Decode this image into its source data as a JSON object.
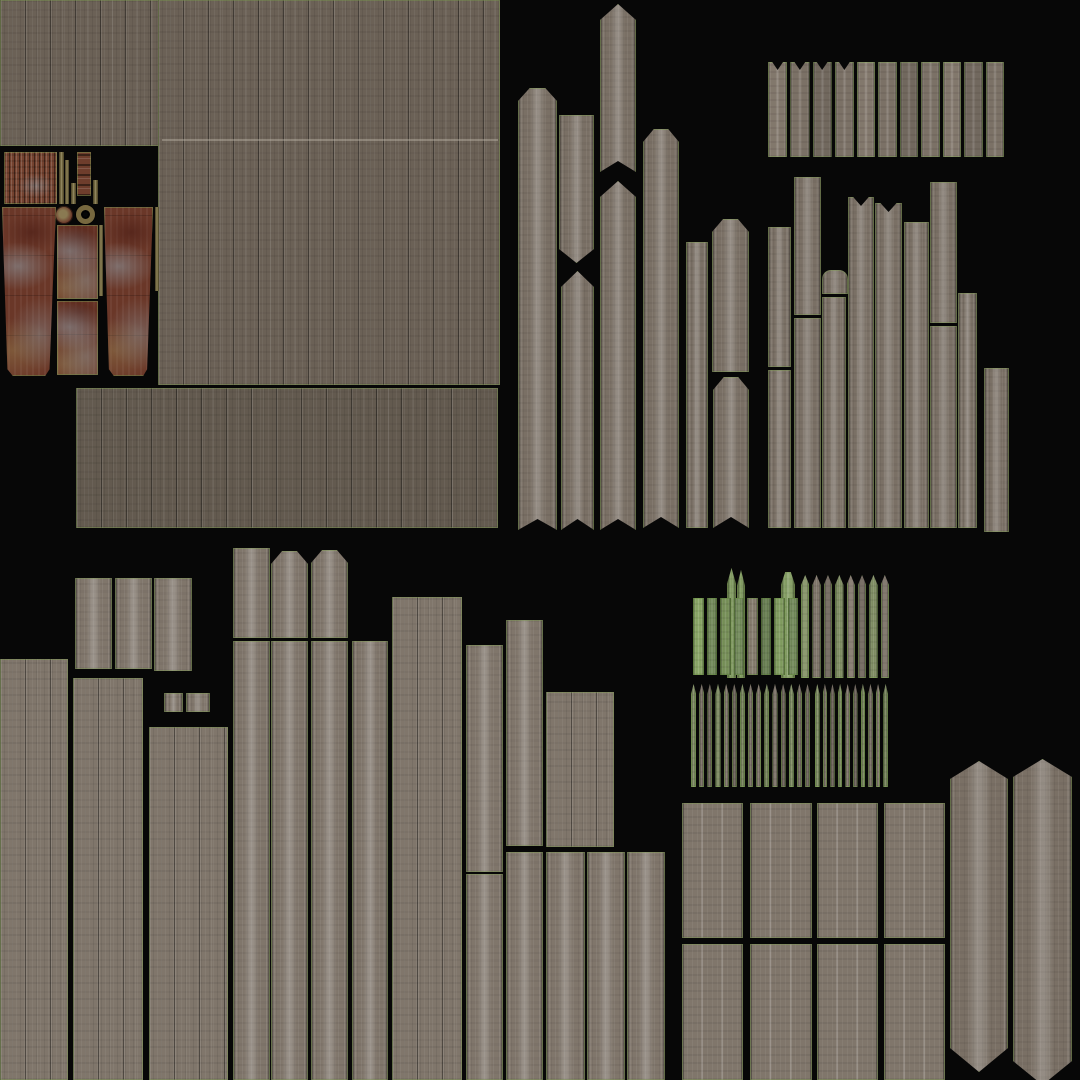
{
  "canvas": {
    "width": 1080,
    "height": 1080,
    "background": "#070707"
  },
  "palette": {
    "wood_brown": "#6b6156",
    "wood_brown_dark": "#635a4f",
    "wood_gray": "#7a7065",
    "wood_light": "#80766b",
    "moss_green": "#7f9a5e",
    "island_border_green": "#7f9b52",
    "rust": "#6a3728",
    "rust_dark": "#54241a",
    "rust_patch_blue": "#8d99a1",
    "rust_khaki": "#7e7347",
    "background_black": "#070707",
    "seam_light": "#c7c0b4"
  },
  "islands": [
    {
      "id": "top-left-strip",
      "material": "wood-boards-brown",
      "shape": "rect",
      "x": 0,
      "y": 0,
      "w": 500,
      "h": 146
    },
    {
      "id": "top-big-block",
      "material": "wood-boards-brown",
      "shape": "rect",
      "x": 158,
      "y": 0,
      "w": 342,
      "h": 385
    },
    {
      "id": "top-big-block-seam",
      "material": "seam-line",
      "shape": "rect",
      "x": 162,
      "y": 139,
      "w": 336,
      "h": 2
    },
    {
      "id": "mid-wide-block",
      "material": "wood-boards-brown-dark",
      "shape": "rect",
      "x": 76,
      "y": 388,
      "w": 422,
      "h": 140
    },
    {
      "id": "rust-corrugated-sheet",
      "material": "rust-corrugated",
      "shape": "rect",
      "x": 4,
      "y": 152,
      "w": 53,
      "h": 52
    },
    {
      "id": "khaki-strip-1",
      "material": "khaki-strip",
      "shape": "rect",
      "x": 59,
      "y": 152,
      "w": 5,
      "h": 52
    },
    {
      "id": "khaki-strip-2",
      "material": "khaki-strip",
      "shape": "rect",
      "x": 65,
      "y": 160,
      "w": 4,
      "h": 44
    },
    {
      "id": "khaki-strip-3",
      "material": "khaki-strip",
      "shape": "rect",
      "x": 71,
      "y": 183,
      "w": 5,
      "h": 21
    },
    {
      "id": "rust-ladder-strip",
      "material": "rust-ladder",
      "shape": "rect",
      "x": 77,
      "y": 152,
      "w": 14,
      "h": 44
    },
    {
      "id": "khaki-strip-4",
      "material": "khaki-strip",
      "shape": "rect",
      "x": 93,
      "y": 180,
      "w": 5,
      "h": 24
    },
    {
      "id": "metal-disc",
      "material": "metal-disc",
      "shape": "rect",
      "x": 55,
      "y": 206,
      "w": 18,
      "h": 18
    },
    {
      "id": "metal-ring",
      "material": "metal-ring",
      "shape": "rect",
      "x": 76,
      "y": 205,
      "w": 19,
      "h": 19
    },
    {
      "id": "rust-panel-left",
      "material": "rust-panel",
      "shape": "taper-bottom",
      "x": 2,
      "y": 207,
      "w": 54,
      "h": 169
    },
    {
      "id": "rust-panel-mid-upper",
      "material": "rust-panel",
      "shape": "rect",
      "x": 57,
      "y": 225,
      "w": 41,
      "h": 74
    },
    {
      "id": "rust-panel-mid-lower",
      "material": "rust-panel",
      "shape": "rect",
      "x": 57,
      "y": 301,
      "w": 41,
      "h": 74
    },
    {
      "id": "khaki-strip-mid",
      "material": "khaki-strip",
      "shape": "rect",
      "x": 99,
      "y": 225,
      "w": 4,
      "h": 71
    },
    {
      "id": "rust-panel-right",
      "material": "rust-panel",
      "shape": "taper-bottom",
      "x": 104,
      "y": 207,
      "w": 49,
      "h": 169
    },
    {
      "id": "khaki-strip-right",
      "material": "khaki-strip",
      "shape": "rect",
      "x": 155,
      "y": 207,
      "w": 4,
      "h": 84
    },
    {
      "id": "mid-plank-a",
      "material": "wood-plank-gray",
      "shape": "chamfer-top-notch-bottom",
      "x": 518,
      "y": 88,
      "w": 39,
      "h": 442
    },
    {
      "id": "mid-plank-b-upper",
      "material": "wood-plank-gray",
      "shape": "point-bottom",
      "x": 559,
      "y": 115,
      "w": 35,
      "h": 148
    },
    {
      "id": "mid-plank-b-lower",
      "material": "wood-plank-gray",
      "shape": "point-top-notch-bottom",
      "x": 561,
      "y": 271,
      "w": 33,
      "h": 259
    },
    {
      "id": "mid-plank-c-upper",
      "material": "wood-plank-gray",
      "shape": "point-top-notch-bottom",
      "x": 600,
      "y": 4,
      "w": 36,
      "h": 168
    },
    {
      "id": "mid-plank-c-lower",
      "material": "wood-plank-gray",
      "shape": "point-top-notch-bottom",
      "x": 600,
      "y": 181,
      "w": 36,
      "h": 349
    },
    {
      "id": "mid-plank-d",
      "material": "wood-plank-gray",
      "shape": "chamfer-top-notch-bottom",
      "x": 643,
      "y": 129,
      "w": 36,
      "h": 399
    },
    {
      "id": "mid-plank-e",
      "material": "wood-plank-gray",
      "shape": "rect",
      "x": 686,
      "y": 242,
      "w": 22,
      "h": 286
    },
    {
      "id": "mid-plank-f",
      "material": "wood-plank-gray",
      "shape": "chamfer-top",
      "x": 712,
      "y": 219,
      "w": 37,
      "h": 153
    },
    {
      "id": "mid-plank-g",
      "material": "wood-plank-gray",
      "shape": "chamfer-top-notch-bottom",
      "x": 713,
      "y": 377,
      "w": 36,
      "h": 151
    },
    {
      "id": "right-plank-1-upper",
      "material": "wood-plank-gray",
      "shape": "rect",
      "x": 768,
      "y": 227,
      "w": 23,
      "h": 140
    },
    {
      "id": "right-plank-1-lower",
      "material": "wood-plank-gray",
      "shape": "rect",
      "x": 768,
      "y": 370,
      "w": 23,
      "h": 158
    },
    {
      "id": "right-plank-2-upper",
      "material": "wood-plank-gray",
      "shape": "rect",
      "x": 794,
      "y": 177,
      "w": 27,
      "h": 138
    },
    {
      "id": "right-plank-2-lower",
      "material": "wood-plank-gray",
      "shape": "rect",
      "x": 794,
      "y": 318,
      "w": 27,
      "h": 210
    },
    {
      "id": "right-knob-piece",
      "material": "wood-plank-gray",
      "shape": "round-top",
      "x": 822,
      "y": 270,
      "w": 26,
      "h": 24
    },
    {
      "id": "right-plank-3",
      "material": "wood-plank-gray",
      "shape": "rect",
      "x": 822,
      "y": 297,
      "w": 24,
      "h": 231
    },
    {
      "id": "right-plank-4",
      "material": "wood-plank-gray",
      "shape": "notch-ears-top",
      "x": 848,
      "y": 197,
      "w": 26,
      "h": 331
    },
    {
      "id": "right-plank-5",
      "material": "wood-plank-gray",
      "shape": "notch-ears-top",
      "x": 875,
      "y": 203,
      "w": 27,
      "h": 325
    },
    {
      "id": "right-plank-6",
      "material": "wood-plank-gray",
      "shape": "rect",
      "x": 904,
      "y": 222,
      "w": 25,
      "h": 306
    },
    {
      "id": "right-plank-7-upper",
      "material": "wood-plank-gray",
      "shape": "rect",
      "x": 930,
      "y": 182,
      "w": 27,
      "h": 141
    },
    {
      "id": "right-plank-7-lower",
      "material": "wood-plank-gray",
      "shape": "rect",
      "x": 930,
      "y": 326,
      "w": 27,
      "h": 202
    },
    {
      "id": "right-plank-8",
      "material": "wood-plank-gray",
      "shape": "rect",
      "x": 958,
      "y": 293,
      "w": 19,
      "h": 235
    },
    {
      "id": "right-plank-9",
      "material": "wood-plank-gray",
      "shape": "rect",
      "x": 984,
      "y": 368,
      "w": 25,
      "h": 164
    },
    {
      "id": "bottom-plank-1",
      "material": "wood-plank-light",
      "shape": "rect",
      "x": 75,
      "y": 578,
      "w": 37,
      "h": 91
    },
    {
      "id": "bottom-plank-2",
      "material": "wood-plank-light",
      "shape": "rect",
      "x": 115,
      "y": 578,
      "w": 37,
      "h": 91
    },
    {
      "id": "bottom-plank-3",
      "material": "wood-plank-light",
      "shape": "rect",
      "x": 154,
      "y": 578,
      "w": 38,
      "h": 93
    },
    {
      "id": "bottom-board-left-edge",
      "material": "wood-boards-light",
      "shape": "rect",
      "x": 0,
      "y": 659,
      "w": 68,
      "h": 421
    },
    {
      "id": "bottom-board-2",
      "material": "wood-boards-light",
      "shape": "rect",
      "x": 73,
      "y": 678,
      "w": 70,
      "h": 402
    },
    {
      "id": "small-square-1",
      "material": "wood-plank-light",
      "shape": "rect",
      "x": 164,
      "y": 693,
      "w": 19,
      "h": 19
    },
    {
      "id": "small-square-2",
      "material": "wood-plank-light",
      "shape": "rect",
      "x": 186,
      "y": 693,
      "w": 24,
      "h": 19
    },
    {
      "id": "bottom-board-3",
      "material": "wood-boards-light",
      "shape": "rect",
      "x": 149,
      "y": 727,
      "w": 79,
      "h": 353
    },
    {
      "id": "bottom-plank-4-upper",
      "material": "wood-plank-light",
      "shape": "rect",
      "x": 233,
      "y": 548,
      "w": 37,
      "h": 90
    },
    {
      "id": "bottom-plank-4-lower",
      "material": "wood-plank-light",
      "shape": "rect",
      "x": 233,
      "y": 641,
      "w": 37,
      "h": 439
    },
    {
      "id": "bottom-plank-5-upper",
      "material": "wood-plank-light",
      "shape": "chamfer-top",
      "x": 271,
      "y": 551,
      "w": 37,
      "h": 87
    },
    {
      "id": "bottom-plank-5-lower",
      "material": "wood-plank-light",
      "shape": "rect",
      "x": 271,
      "y": 641,
      "w": 37,
      "h": 439
    },
    {
      "id": "bottom-plank-6-upper",
      "material": "wood-plank-light",
      "shape": "chamfer-top",
      "x": 311,
      "y": 550,
      "w": 37,
      "h": 88
    },
    {
      "id": "bottom-plank-6-lower",
      "material": "wood-plank-light",
      "shape": "rect",
      "x": 311,
      "y": 641,
      "w": 37,
      "h": 439
    },
    {
      "id": "bottom-plank-7",
      "material": "wood-plank-light",
      "shape": "rect",
      "x": 352,
      "y": 641,
      "w": 36,
      "h": 439
    },
    {
      "id": "bottom-board-wide",
      "material": "wood-boards-light",
      "shape": "rect",
      "x": 392,
      "y": 597,
      "w": 70,
      "h": 483
    },
    {
      "id": "bottom-plank-8-upper",
      "material": "wood-plank-light",
      "shape": "rect",
      "x": 466,
      "y": 645,
      "w": 37,
      "h": 227
    },
    {
      "id": "bottom-plank-8-lower",
      "material": "wood-plank-light",
      "shape": "rect",
      "x": 466,
      "y": 874,
      "w": 37,
      "h": 206
    },
    {
      "id": "bottom-plank-9-upper",
      "material": "wood-plank-light",
      "shape": "rect",
      "x": 506,
      "y": 620,
      "w": 37,
      "h": 226
    },
    {
      "id": "bottom-plank-9-lower",
      "material": "wood-plank-light",
      "shape": "rect",
      "x": 506,
      "y": 852,
      "w": 37,
      "h": 228
    },
    {
      "id": "bottom-board-mid",
      "material": "wood-boards-light",
      "shape": "rect",
      "x": 546,
      "y": 692,
      "w": 68,
      "h": 155
    },
    {
      "id": "bottom-plank-10",
      "material": "wood-plank-light",
      "shape": "rect",
      "x": 546,
      "y": 852,
      "w": 39,
      "h": 228
    },
    {
      "id": "bottom-plank-11",
      "material": "wood-plank-light",
      "shape": "rect",
      "x": 587,
      "y": 852,
      "w": 38,
      "h": 228
    },
    {
      "id": "bottom-plank-12",
      "material": "wood-plank-light",
      "shape": "rect",
      "x": 627,
      "y": 852,
      "w": 38,
      "h": 228
    },
    {
      "id": "moss-tall-picket-1",
      "material": "moss-plank",
      "shape": "point-top-small",
      "x": 727,
      "y": 568,
      "w": 9,
      "h": 110
    },
    {
      "id": "moss-tall-picket-2",
      "material": "moss-plank",
      "shape": "point-top-small",
      "x": 737,
      "y": 570,
      "w": 8,
      "h": 108
    },
    {
      "id": "moss-tall-picket-3",
      "material": "moss-plank",
      "shape": "chamfer-top",
      "x": 781,
      "y": 572,
      "w": 14,
      "h": 106
    },
    {
      "id": "grid-panel-r1c1",
      "material": "wood-boards-panel",
      "shape": "rect",
      "x": 682,
      "y": 803,
      "w": 61,
      "h": 135
    },
    {
      "id": "grid-panel-r1c2",
      "material": "wood-boards-panel",
      "shape": "rect",
      "x": 750,
      "y": 803,
      "w": 62,
      "h": 135
    },
    {
      "id": "grid-panel-r1c3",
      "material": "wood-boards-panel",
      "shape": "rect",
      "x": 817,
      "y": 803,
      "w": 61,
      "h": 135
    },
    {
      "id": "grid-panel-r1c4",
      "material": "wood-boards-panel",
      "shape": "rect",
      "x": 884,
      "y": 803,
      "w": 61,
      "h": 135
    },
    {
      "id": "grid-panel-r2c1",
      "material": "wood-boards-panel",
      "shape": "rect",
      "x": 682,
      "y": 944,
      "w": 61,
      "h": 136
    },
    {
      "id": "grid-panel-r2c2",
      "material": "wood-boards-panel",
      "shape": "rect",
      "x": 750,
      "y": 944,
      "w": 62,
      "h": 136
    },
    {
      "id": "grid-panel-r2c3",
      "material": "wood-boards-panel",
      "shape": "rect",
      "x": 817,
      "y": 944,
      "w": 61,
      "h": 136
    },
    {
      "id": "grid-panel-r2c4",
      "material": "wood-boards-panel",
      "shape": "rect",
      "x": 884,
      "y": 944,
      "w": 61,
      "h": 136
    },
    {
      "id": "hex-pale-1",
      "material": "wood-plank-gray",
      "shape": "hexagon",
      "x": 950,
      "y": 761,
      "w": 58,
      "h": 311
    },
    {
      "id": "hex-pale-2",
      "material": "wood-plank-gray",
      "shape": "hexagon",
      "x": 1013,
      "y": 759,
      "w": 59,
      "h": 326
    }
  ],
  "picket_groups": [
    {
      "id": "fence-strip-notched",
      "tint": "fence",
      "tip": "ear",
      "count": 4,
      "x": 768,
      "y": 62,
      "w": 86,
      "h": 95
    },
    {
      "id": "fence-strip-flat",
      "tint": "fence",
      "tip": "flat",
      "count": 7,
      "x": 857,
      "y": 62,
      "w": 147,
      "h": 95
    },
    {
      "id": "moss-picket-group-left",
      "tint": "heavy",
      "tip": "flat",
      "count": 8,
      "x": 693,
      "y": 598,
      "w": 105,
      "h": 77
    },
    {
      "id": "picket-group-right",
      "tint": "mid",
      "tip": "point",
      "count": 8,
      "x": 801,
      "y": 575,
      "w": 88,
      "h": 103
    },
    {
      "id": "picket-row-2-left",
      "tint": "mid",
      "tip": "point",
      "count": 15,
      "x": 691,
      "y": 684,
      "w": 119,
      "h": 103
    },
    {
      "id": "picket-row-2-right",
      "tint": "mid",
      "tip": "point",
      "count": 10,
      "x": 815,
      "y": 684,
      "w": 73,
      "h": 103
    }
  ]
}
